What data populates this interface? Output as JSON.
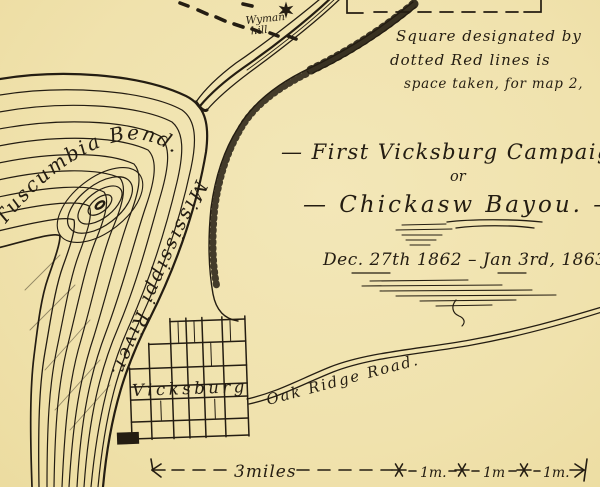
{
  "colors": {
    "parchment": "#f0e2ad",
    "ink": "#241d12"
  },
  "header_note": {
    "line1": "Square designated by",
    "line2": "dotted Red lines is",
    "line3": "space taken, for map 2,"
  },
  "title": {
    "line1": "— First Vicksburg Campaign —",
    "line2": "or",
    "line3": "— Chickasw Bayou. —",
    "date": "Dec. 27th 1862 – Jan 3rd, 1863"
  },
  "labels": {
    "bend": "Tuscumbia Bend.",
    "river": "Mississippi River.",
    "city": "Vicksburg",
    "road": "Oak Ridge Road.",
    "hill_line1": "Wyman",
    "hill_line2": "hill"
  },
  "scale_bar": {
    "miles": "3miles",
    "seg1": "1m.",
    "seg2": "1m",
    "seg3": "1m."
  },
  "icons": {
    "fort_symbol": "star-fort",
    "route_symbol": "dotted-trail"
  }
}
